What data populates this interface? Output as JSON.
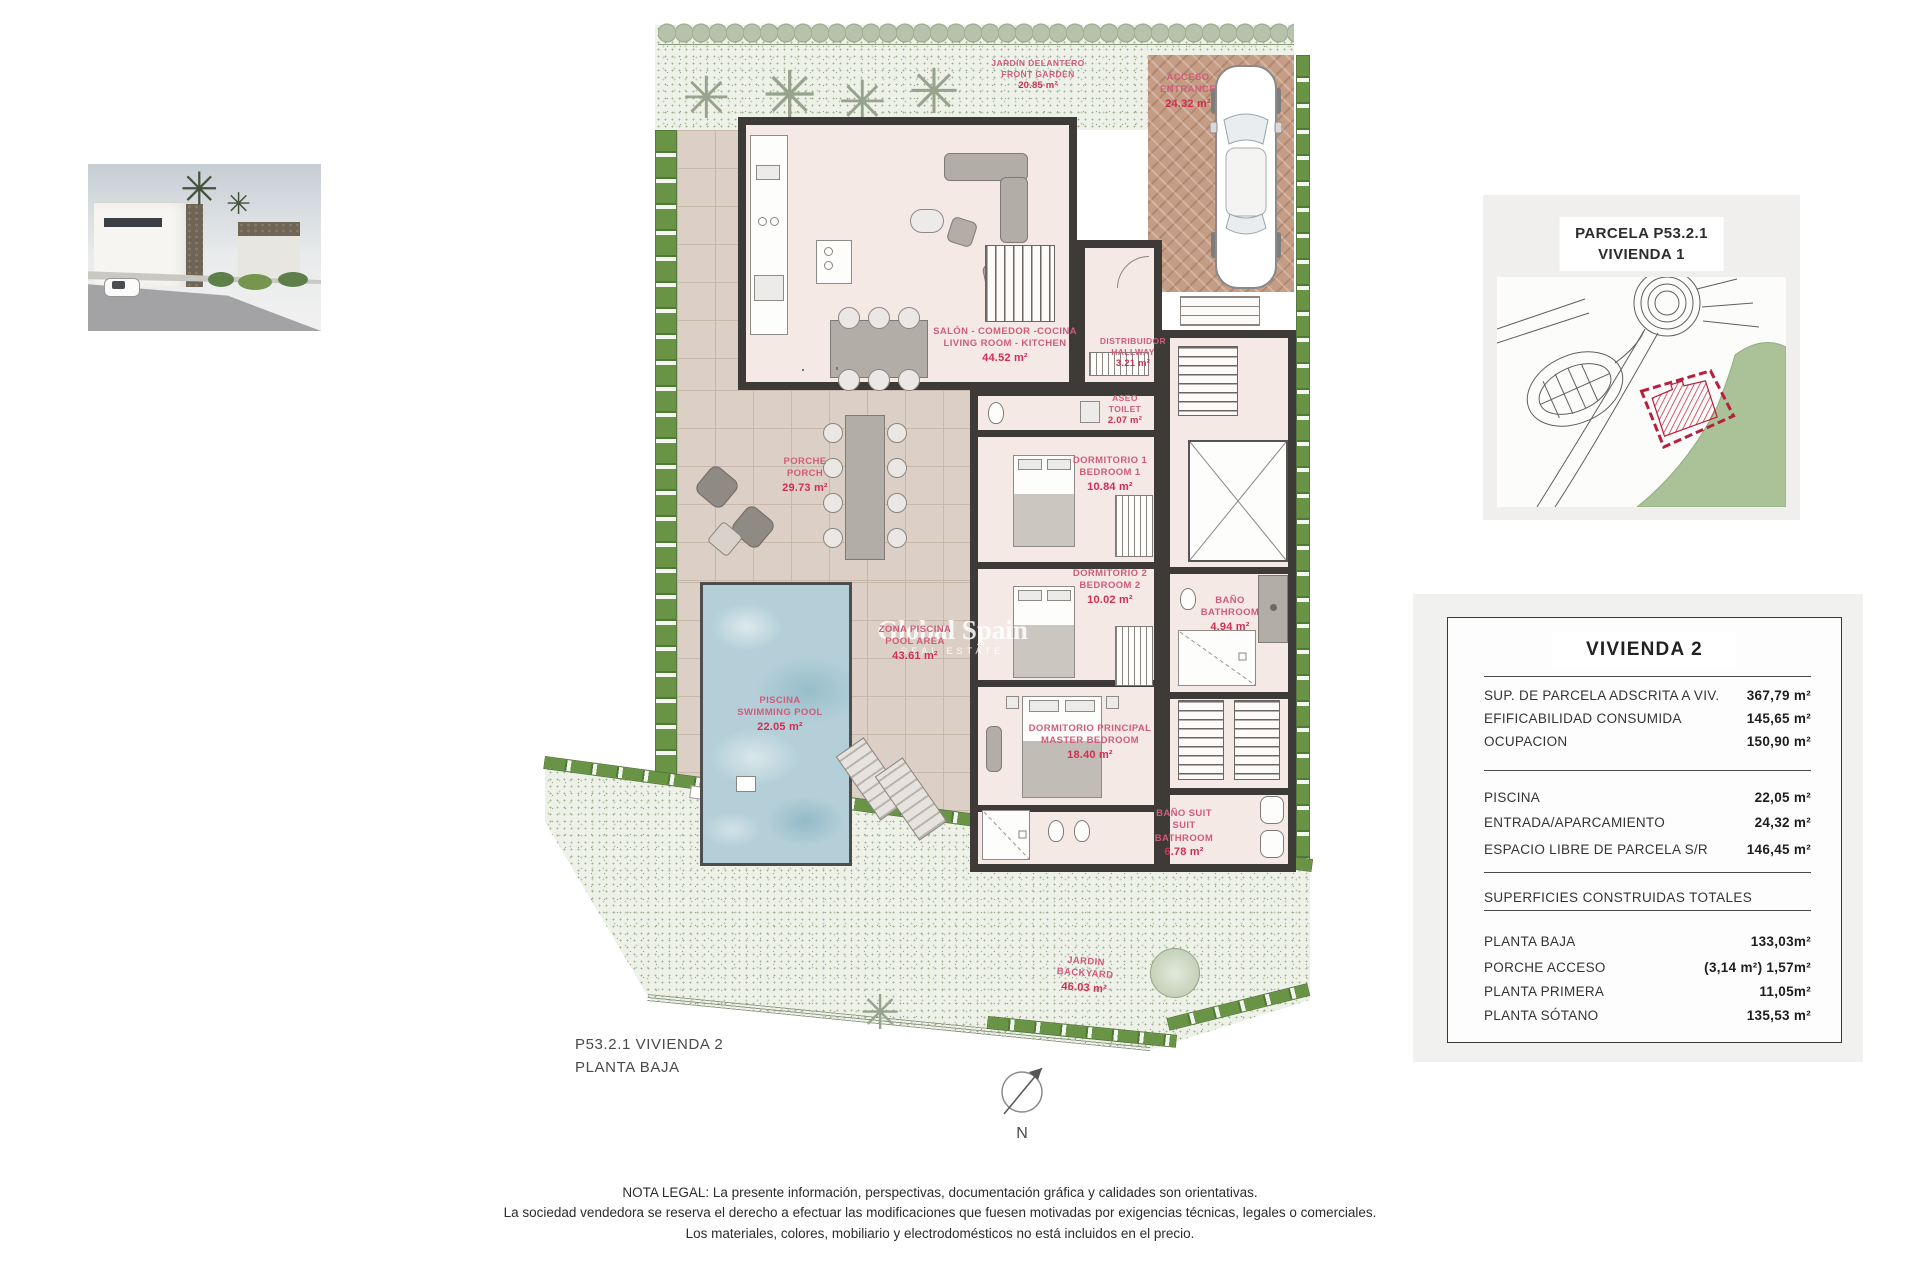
{
  "plan": {
    "sheet_title_line1": "P53.2.1 VIVIENDA 2",
    "sheet_title_line2": "PLANTA BAJA",
    "north_label": "N",
    "watermark": {
      "line1": "Global Spain",
      "line2": "REAL ESTATE"
    },
    "rooms": {
      "salon": {
        "es": "SALÓN - COMEDOR -COCINA",
        "en": "LIVING ROOM - KITCHEN",
        "area": "44.52 m²"
      },
      "distribuidor": {
        "es": "DISTRIBUIDOR",
        "en": "HALLWAY",
        "area": "3.21 m²"
      },
      "aseo": {
        "es": "ASEO",
        "en": "TOILET",
        "area": "2.07 m²"
      },
      "dormitorio1": {
        "es": "DORMITORIO 1",
        "en": "BEDROOM 1",
        "area": "10.84 m²"
      },
      "dormitorio2": {
        "es": "DORMITORIO 2",
        "en": "BEDROOM 2",
        "area": "10.02 m²"
      },
      "bano": {
        "es": "BAÑO",
        "en": "BATHROOM",
        "area": "4.94 m²"
      },
      "principal": {
        "es": "DORMITORIO PRINCIPAL",
        "en": "MASTER BEDROOM",
        "area": "18.40 m²"
      },
      "banosuit": {
        "es": "BAÑO SUIT",
        "en": "SUIT BATHROOM",
        "area": "6.78 m²"
      },
      "porche": {
        "es": "PORCHE",
        "en": "PORCH",
        "area": "29.73 m²"
      },
      "zona_piscina": {
        "es": "ZONA PISCINA",
        "en": "POOL AREA",
        "area": "43.61 m²"
      },
      "piscina": {
        "es": "PISCINA",
        "en": "SWIMMING POOL",
        "area": "22.05 m²"
      },
      "acceso": {
        "es": "ACCESO",
        "en": "ENTRANCE",
        "area": "24.32 m²"
      },
      "jardin_delantero": {
        "es": "JARDIN DELANTERO",
        "en": "FRONT GARDEN",
        "area": "20.85 m²"
      },
      "jardin": {
        "es": "JARDIN",
        "en": "BACKYARD",
        "area": "46.03 m²"
      }
    }
  },
  "location_panel": {
    "title_line1": "PARCELA P53.2.1",
    "title_line2": "VIVIENDA 1"
  },
  "summary_panel": {
    "title": "VIVIENDA 2",
    "parcel_rows": [
      {
        "label": "SUP. DE PARCELA ADSCRITA A VIV.",
        "value": "367,79 m²"
      },
      {
        "label": "EFIFICABILIDAD CONSUMIDA",
        "value": "145,65 m²"
      },
      {
        "label": "OCUPACION",
        "value": "150,90 m²"
      }
    ],
    "exterior_rows": [
      {
        "label": "PISCINA",
        "value": "22,05 m²"
      },
      {
        "label": "ENTRADA/APARCAMIENTO",
        "value": "24,32 m²"
      },
      {
        "label": "ESPACIO LIBRE DE PARCELA S/R",
        "value": "146,45 m²"
      }
    ],
    "built_title": "SUPERFICIES CONSTRUIDAS TOTALES",
    "built_rows": [
      {
        "label": "PLANTA BAJA",
        "value": "133,03m²"
      },
      {
        "label": "PORCHE ACCESO",
        "value": "(3,14 m²) 1,57m²"
      },
      {
        "label": "PLANTA PRIMERA",
        "value": "11,05m²"
      },
      {
        "label": "PLANTA SÓTANO",
        "value": "135,53 m²"
      }
    ]
  },
  "legal": {
    "line1": "NOTA LEGAL: La presente información, perspectivas, documentación gráfica y calidades son orientativas.",
    "line2": "La sociedad vendedora se reserva el derecho a efectuar las modificaciones que fuesen motivadas por exigencias técnicas, legales o comerciales.",
    "line3": "Los materiales, colores, mobiliario y electrodomésticos no está incluidos en el precio."
  },
  "colors": {
    "label_pink": "#cf5d79",
    "area_red": "#d22e55",
    "parcel_red": "#b81f3c",
    "map_green": "#abc298"
  }
}
